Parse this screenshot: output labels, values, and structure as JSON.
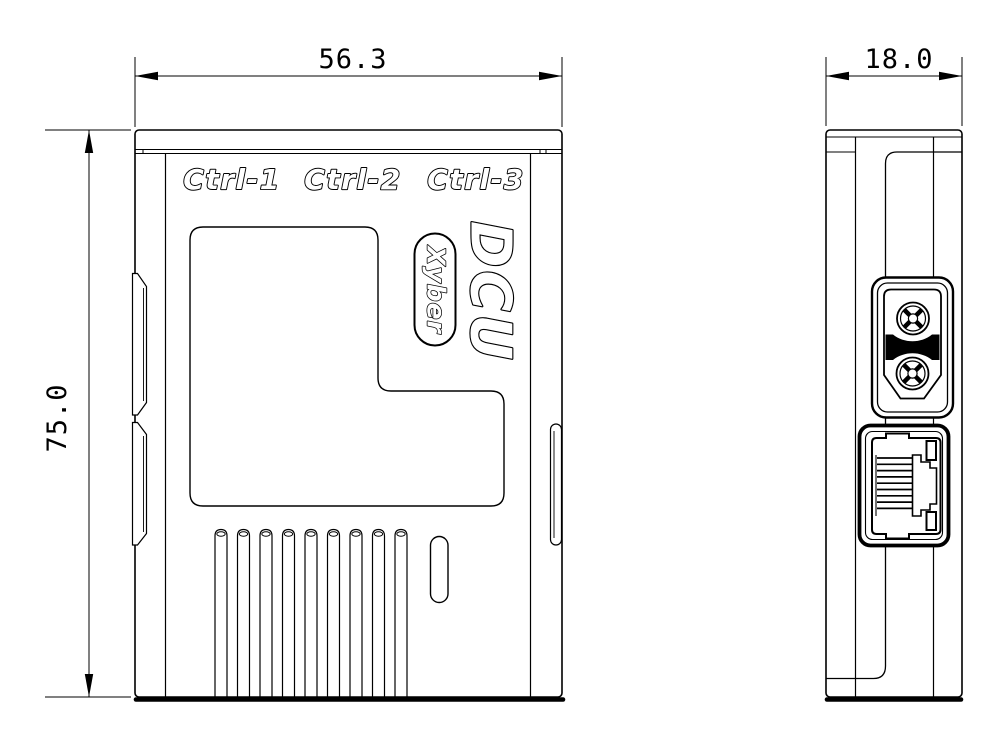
{
  "colors": {
    "background": "#ffffff",
    "line": "#000000"
  },
  "dimensions": {
    "front_width": "56.3",
    "front_height": "75.0",
    "side_width": "18.0"
  },
  "front_view": {
    "port_labels": [
      "Ctrl-1",
      "Ctrl-2",
      "Ctrl-3"
    ],
    "logo": "DCU",
    "brand": "Xyber",
    "vent_slot_count": 9
  },
  "side_view": {
    "rj45_pin_count": 9,
    "features": [
      "xt30-power-connector",
      "rj45-ethernet-port"
    ]
  }
}
